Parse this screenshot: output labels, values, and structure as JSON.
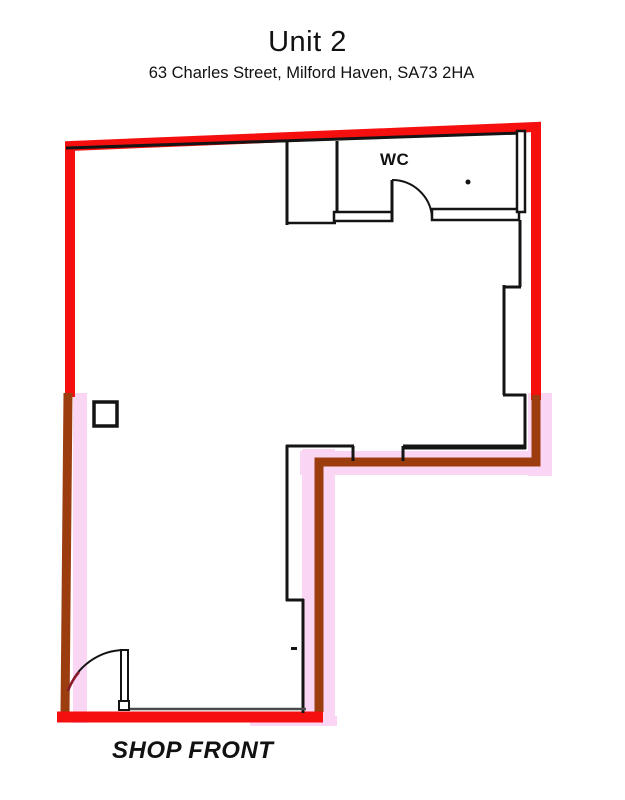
{
  "title": "Unit 2",
  "address": "63 Charles Street, Milford Haven, SA73 2HA",
  "plan": {
    "wc_label": "WC",
    "shop_front_label": "SHOP FRONT"
  },
  "colors": {
    "boundary_red": "#f50f0f",
    "boundary_brown": "#9c3d10",
    "highlight_pink": "#fbd6f4",
    "wall_black": "#141414",
    "door_accent_maroon": "#8b1a2b"
  }
}
